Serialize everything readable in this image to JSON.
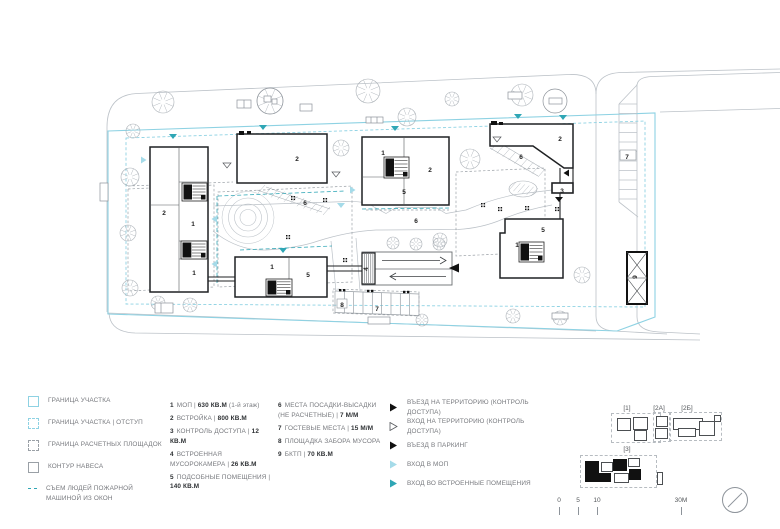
{
  "plan": {
    "labels": [
      {
        "t": "2",
        "x": 164,
        "y": 213
      },
      {
        "t": "1",
        "x": 193,
        "y": 224
      },
      {
        "t": "1",
        "x": 194,
        "y": 273
      },
      {
        "t": "2",
        "x": 297,
        "y": 159
      },
      {
        "t": "1",
        "x": 383,
        "y": 153
      },
      {
        "t": "2",
        "x": 430,
        "y": 170
      },
      {
        "t": "5",
        "x": 404,
        "y": 192
      },
      {
        "t": "2",
        "x": 560,
        "y": 139
      },
      {
        "t": "6",
        "x": 521,
        "y": 157
      },
      {
        "t": "6",
        "x": 305,
        "y": 203
      },
      {
        "t": "6",
        "x": 416,
        "y": 221
      },
      {
        "t": "3",
        "x": 562,
        "y": 191
      },
      {
        "t": "7",
        "x": 627,
        "y": 157
      },
      {
        "t": "5",
        "x": 543,
        "y": 230
      },
      {
        "t": "1",
        "x": 517,
        "y": 245
      },
      {
        "t": "1",
        "x": 272,
        "y": 267
      },
      {
        "t": "5",
        "x": 308,
        "y": 275
      },
      {
        "t": "8",
        "x": 342,
        "y": 305
      },
      {
        "t": "7",
        "x": 377,
        "y": 309
      }
    ],
    "rotated_labels": [
      {
        "t": "4",
        "x": 368,
        "y": 269,
        "rot": -90
      },
      {
        "t": "9",
        "x": 637,
        "y": 277,
        "rot": -90
      }
    ]
  },
  "legend": {
    "boundary_items": [
      {
        "swatch": "solid-cyan",
        "label": "ГРАНИЦА УЧАСТКА"
      },
      {
        "swatch": "dashed-cyan",
        "label": "ГРАНИЦА УЧАСТКА | ОТСТУП"
      },
      {
        "swatch": "dashed-gray",
        "label": "ГРАНИЦА РАСЧЕТНЫХ ПЛОЩАДОК"
      },
      {
        "swatch": "solid-gray",
        "label": "КОНТУР НАВЕСА"
      },
      {
        "swatch": "line-teal",
        "label": "СЪЕМ ЛЮДЕЙ ПОЖАРНОЙ МАШИНОЙ ИЗ ОКОН"
      }
    ],
    "area_items": [
      {
        "num": "1",
        "text": "МОП | ",
        "value": "630 КВ.М",
        "suffix": " (1-й этаж)"
      },
      {
        "num": "2",
        "text": "ВСТРОЙКА | ",
        "value": "800 КВ.М",
        "suffix": ""
      },
      {
        "num": "3",
        "text": "КОНТРОЛЬ ДОСТУПА | ",
        "value": "12 КВ.М",
        "suffix": ""
      },
      {
        "num": "4",
        "text": "ВСТРОЕННАЯ МУСОРОКАМЕРА | ",
        "value": "26 КВ.М",
        "suffix": ""
      },
      {
        "num": "5",
        "text": "ПОДСОБНЫЕ ПОМЕЩЕНИЯ | ",
        "value": "140 КВ.М",
        "suffix": ""
      }
    ],
    "site_items": [
      {
        "num": "6",
        "text": "МЕСТА ПОСАДКИ-ВЫСАДКИ (НЕ РАСЧЕТНЫЕ) | ",
        "value": "7 М/М",
        "suffix": ""
      },
      {
        "num": "7",
        "text": "ГОСТЕВЫЕ МЕСТА | ",
        "value": "15 М/М",
        "suffix": ""
      },
      {
        "num": "8",
        "text": "ПЛОЩАДКА ЗАБОРА МУСОРА",
        "value": "",
        "suffix": ""
      },
      {
        "num": "9",
        "text": "БКТП | ",
        "value": "70 КВ.М",
        "suffix": ""
      }
    ],
    "arrow_items": [
      {
        "arrow": "black",
        "label": "ВЪЕЗД НА ТЕРРИТОРИЮ (КОНТРОЛЬ ДОСТУПА)"
      },
      {
        "arrow": "outline",
        "label": "ВХОД НА ТЕРРИТОРИЮ (КОНТРОЛЬ ДОСТУПА)"
      },
      {
        "arrow": "black",
        "label": "ВЪЕЗД В ПАРКИНГ"
      },
      {
        "arrow": "light-cyan",
        "label": "ВХОД В МОП"
      },
      {
        "arrow": "teal",
        "label": "ВХОД ВО ВСТРОЕННЫЕ ПОМЕЩЕНИЯ"
      }
    ]
  },
  "key_plans": {
    "labels": [
      "[1]",
      "[2А]",
      "[2Б]",
      "[3]"
    ]
  },
  "scale_bar": {
    "ticks": [
      "0",
      "5",
      "10",
      "30М"
    ]
  },
  "colors": {
    "cyan": "#8ed2e3",
    "teal": "#2fa6b5",
    "light_cyan_arrow": "#a5dbe9",
    "street_gray": "#bcc2c8",
    "dash_gray": "#9aa0a6",
    "building_black": "#1f2123"
  }
}
